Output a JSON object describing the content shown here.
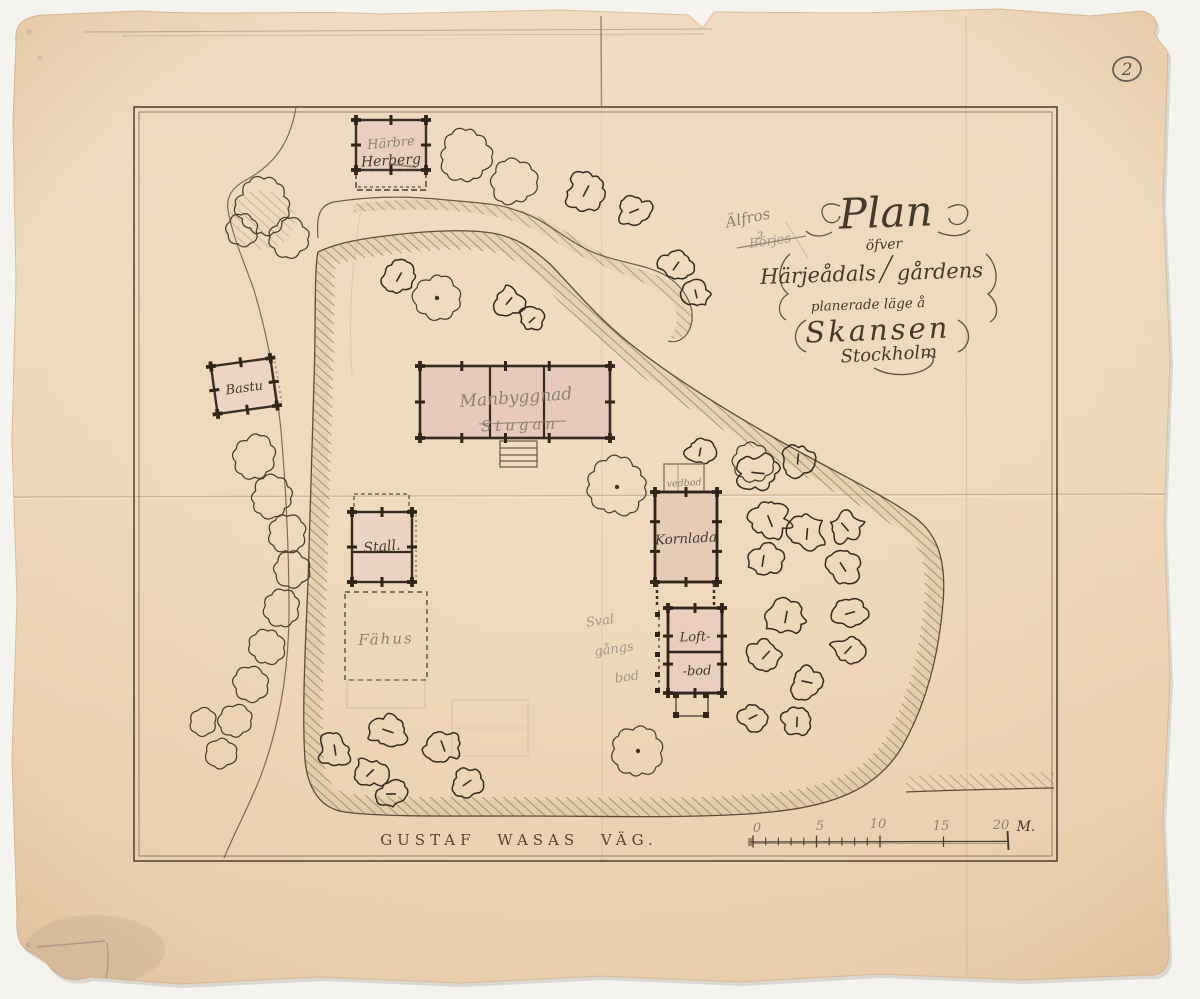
{
  "colors": {
    "scanner_bg": "#f4f3f0",
    "paper": "#edd5b8",
    "ink": "#46382a",
    "pencil": "#8d8170",
    "wash_pink": "#e8c9ba",
    "hatch": "#80704f",
    "frame": "#564737"
  },
  "document": {
    "archive_number": "2",
    "title": {
      "line1": "Plan",
      "line2": "öfver",
      "line3a": "Härjeådals",
      "line3b": "gårdens",
      "line4": "planerade läge å",
      "line5": "Skansen",
      "line6": "Stockholm"
    },
    "pencil_notes": {
      "place": "Älfros",
      "place_number": "2",
      "crossed_out": "Börjes",
      "sval_line1": "Sval",
      "sval_line2": "gångs",
      "sval_line3": "bod"
    },
    "road_name": "GUSTAF WASAS VÄG.",
    "buildings": {
      "harbre_pencil": "Härbre",
      "harbre_ink": "Herberg",
      "bastu": "Bastu",
      "manbyggnad": "Manbyggnad",
      "stugan": "Stugan",
      "stall": "Stall.",
      "fahus": "Fähus",
      "vedbod": "vedbod",
      "kornlada": "Kornlada",
      "loftbod_line1": "Loft-",
      "loftbod_line2": "-bod"
    },
    "scale_bar": {
      "t0": "0",
      "t5": "5",
      "t10": "10",
      "t15": "15",
      "t20": "20",
      "unit": "M."
    }
  },
  "map": {
    "trees": [
      [
        "c",
        263,
        207,
        26,
        0
      ],
      [
        "c",
        288,
        238,
        18,
        0
      ],
      [
        "c",
        242,
        229,
        15,
        0
      ],
      [
        "c",
        466,
        156,
        24,
        0
      ],
      [
        "c",
        514,
        182,
        21,
        0
      ],
      [
        "c",
        437,
        298,
        21,
        1
      ],
      [
        "c",
        617,
        487,
        27,
        1
      ],
      [
        "c",
        752,
        462,
        19,
        0
      ],
      [
        "c",
        638,
        751,
        23,
        1
      ],
      [
        "c",
        254,
        458,
        21,
        0
      ],
      [
        "c",
        272,
        497,
        19,
        0
      ],
      [
        "c",
        287,
        533,
        17,
        0
      ],
      [
        "c",
        292,
        569,
        16,
        0
      ],
      [
        "c",
        282,
        608,
        17,
        0
      ],
      [
        "c",
        266,
        646,
        17,
        0
      ],
      [
        "c",
        251,
        684,
        16,
        0
      ],
      [
        "c",
        236,
        721,
        15,
        0
      ],
      [
        "c",
        222,
        753,
        14,
        0
      ],
      [
        "c",
        203,
        722,
        13,
        0
      ],
      [
        "s",
        399,
        277,
        15,
        0
      ],
      [
        "s",
        509,
        301,
        14,
        0
      ],
      [
        "s",
        532,
        320,
        12,
        0
      ],
      [
        "s",
        586,
        191,
        18,
        0
      ],
      [
        "s",
        634,
        211,
        15,
        0
      ],
      [
        "s",
        676,
        266,
        15,
        0
      ],
      [
        "s",
        696,
        294,
        13,
        0
      ],
      [
        "s",
        700,
        452,
        13,
        0
      ],
      [
        "s",
        758,
        473,
        19,
        0
      ],
      [
        "s",
        798,
        459,
        16,
        0
      ],
      [
        "s",
        770,
        521,
        18,
        0
      ],
      [
        "s",
        807,
        534,
        17,
        0
      ],
      [
        "s",
        845,
        527,
        16,
        0
      ],
      [
        "s",
        763,
        561,
        17,
        0
      ],
      [
        "s",
        843,
        567,
        16,
        0
      ],
      [
        "s",
        786,
        617,
        18,
        0
      ],
      [
        "s",
        850,
        613,
        15,
        0
      ],
      [
        "s",
        766,
        655,
        16,
        0
      ],
      [
        "s",
        848,
        650,
        15,
        0
      ],
      [
        "s",
        807,
        682,
        16,
        0
      ],
      [
        "s",
        753,
        717,
        14,
        0
      ],
      [
        "s",
        797,
        722,
        15,
        0
      ],
      [
        "s",
        335,
        750,
        16,
        0
      ],
      [
        "s",
        388,
        731,
        17,
        0
      ],
      [
        "s",
        370,
        773,
        15,
        0
      ],
      [
        "s",
        391,
        794,
        14,
        0
      ],
      [
        "s",
        443,
        746,
        17,
        0
      ],
      [
        "s",
        467,
        783,
        15,
        0
      ]
    ]
  }
}
